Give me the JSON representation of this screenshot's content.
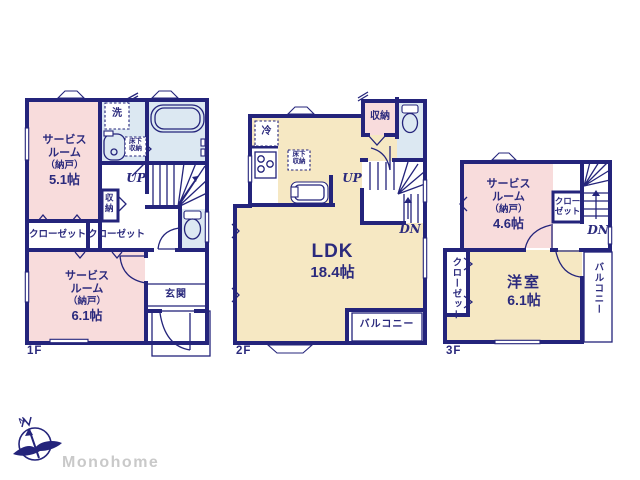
{
  "colors": {
    "wall": "#24247b",
    "text": "#2b2a7d",
    "pink": "#f8dcdc",
    "cream": "#f6e8c3",
    "blue": "#dce8f2",
    "gray": "#c9c9c9"
  },
  "floor1": {
    "label": "1F",
    "service_room_small": {
      "line1": "サービス",
      "line2": "ルーム",
      "line3": "（納戸）",
      "size": "5.1帖"
    },
    "service_room_large": {
      "line1": "サービス",
      "line2": "ルーム",
      "line3": "（納戸）",
      "size": "6.1帖"
    },
    "laundry": "洗",
    "underfloor_storage": {
      "line1": "床下",
      "line2": "収納"
    },
    "stairs_up": "UP",
    "storage": "収納",
    "closet_left": "クローゼット",
    "closet_right": "クローゼット",
    "entrance": "玄関"
  },
  "floor2": {
    "label": "2F",
    "refrigerator": "冷",
    "underfloor_storage": {
      "line1": "床下",
      "line2": "収納"
    },
    "storage": "収納",
    "stairs_up": "UP",
    "stairs_down": "DN",
    "ldk_name": "LDK",
    "ldk_size": "18.4帖",
    "balcony": "バルコニー"
  },
  "floor3": {
    "label": "3F",
    "service_room": {
      "line1": "サービス",
      "line2": "ルーム",
      "line3": "（納戸）",
      "size": "4.6帖"
    },
    "closet_upper": {
      "line1": "クロー",
      "line2": "ゼット"
    },
    "stairs_down": "DN",
    "closet_side": "クローゼット",
    "western_room_name": "洋室",
    "western_room_size": "6.1帖",
    "balcony": "バルコニー"
  },
  "footer": {
    "logo_text": "Monohome",
    "compass_label": "N"
  }
}
